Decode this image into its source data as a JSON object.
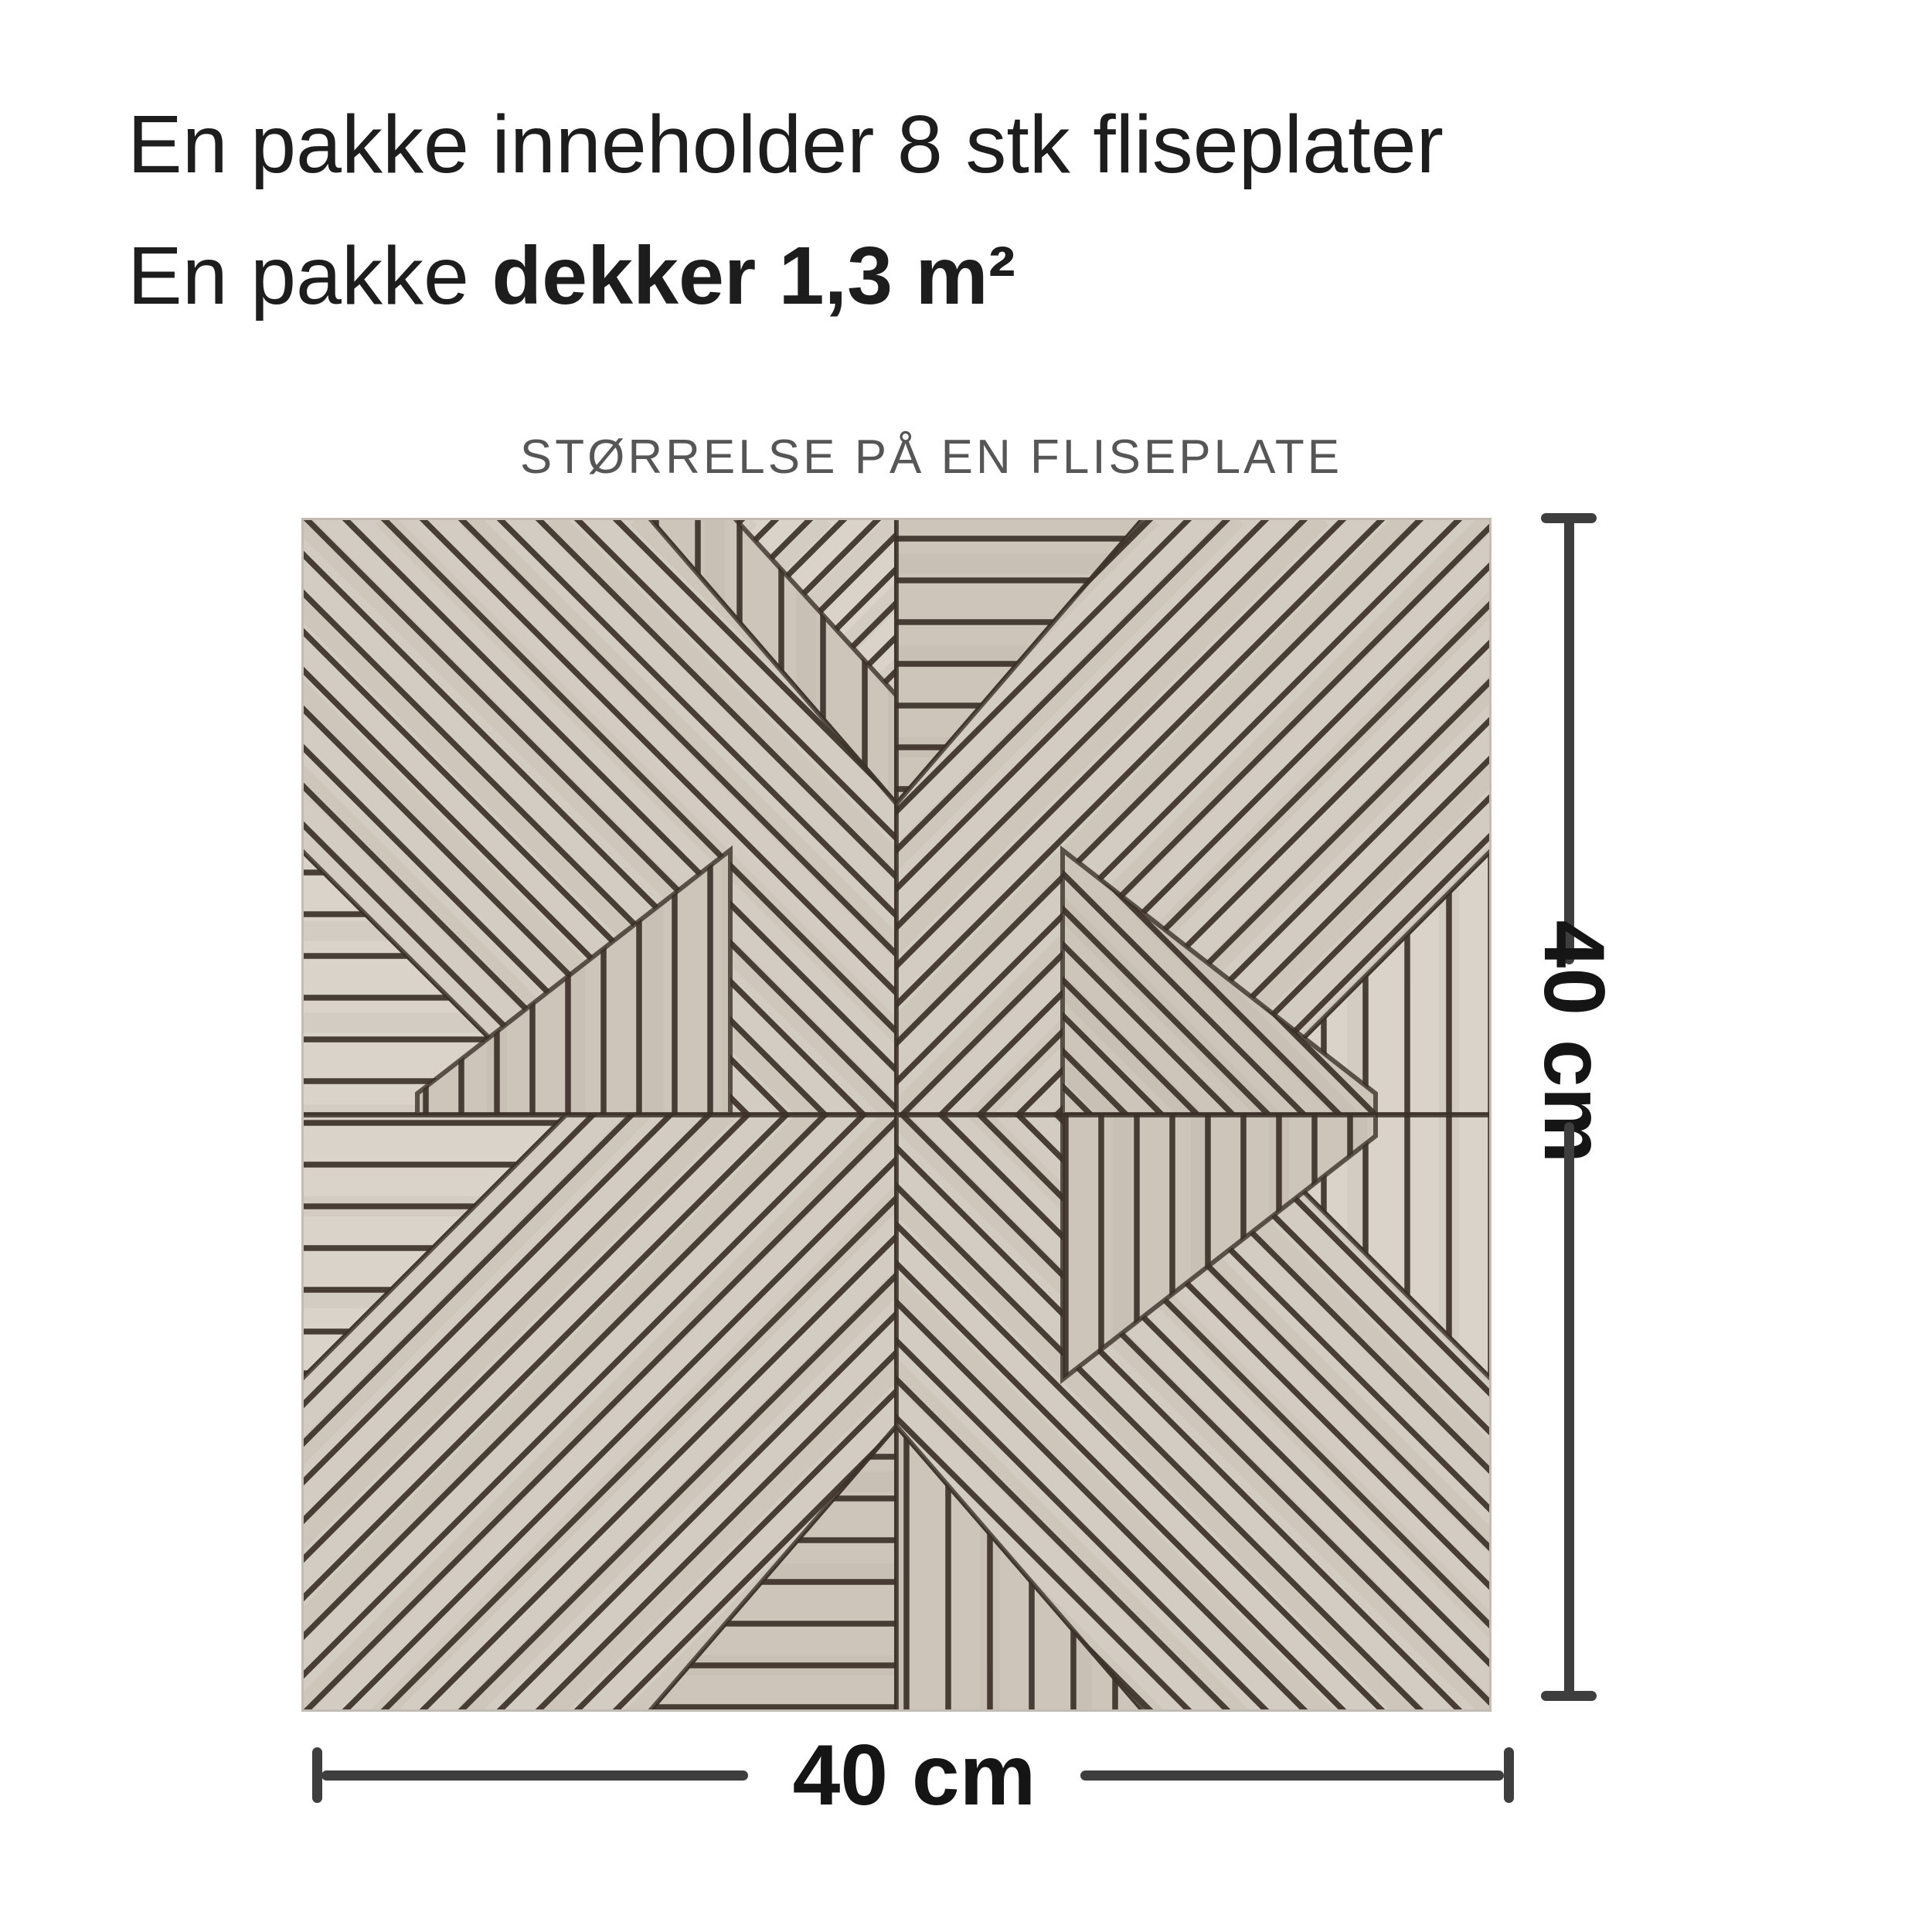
{
  "page": {
    "background": "#ffffff"
  },
  "heading": {
    "line1": "En pakke inneholder 8 stk fliseplater",
    "line2_regular": "En pakke ",
    "line2_bold": "dekker 1,3 m²",
    "color": "#1d1d1d"
  },
  "caption": {
    "text": "STØRRELSE PÅ EN FLISEPLATE",
    "color": "#565656"
  },
  "tile": {
    "wood_base": "#d3ccc2",
    "wood_light": "#d9d3ca",
    "wood_mid": "#cdc5ba",
    "wood_dark": "#b2a89b",
    "groove": "#3b3129",
    "edge": "#c2bcb2"
  },
  "dimensions": {
    "height_label": "40 cm",
    "width_label": "40 cm",
    "line_color": "#3e3e3e",
    "label_color": "#151515"
  }
}
